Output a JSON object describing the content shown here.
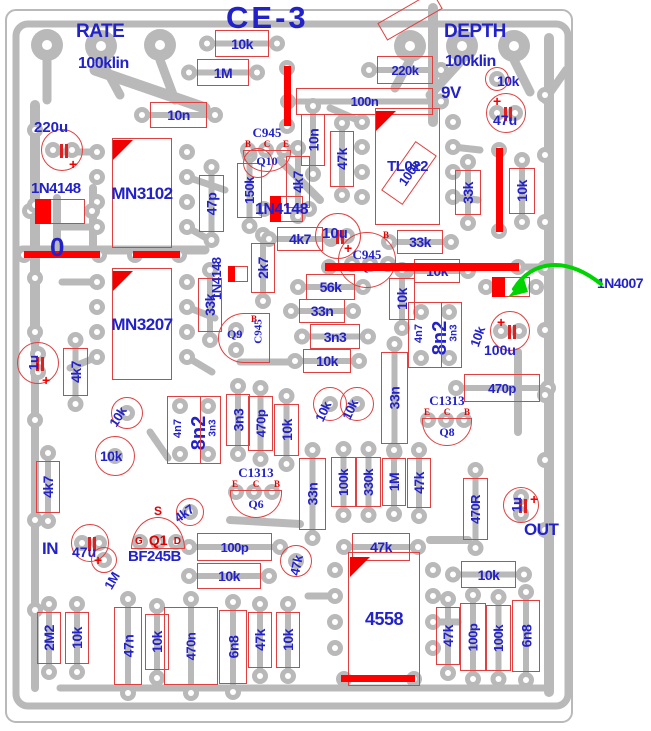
{
  "title": "CE-3",
  "colors": {
    "trace": "#b9b9b9",
    "outline": "#e04040",
    "label_blue": "#2222c8",
    "jumper_red": "#ff0000",
    "arrow_green": "#00d400",
    "background": "#ffffff"
  },
  "annotations": [
    {
      "t": "RATE",
      "x": 76,
      "y": 22,
      "s": 19
    },
    {
      "t": "100klin",
      "x": 78,
      "y": 56,
      "s": 16
    },
    {
      "t": "DEPTH",
      "x": 444,
      "y": 22,
      "s": 19
    },
    {
      "t": "100klin",
      "x": 445,
      "y": 54,
      "s": 16
    },
    {
      "t": "9V",
      "x": 441,
      "y": 84,
      "s": 17
    },
    {
      "t": "IN",
      "x": 42,
      "y": 540,
      "s": 17
    },
    {
      "t": "OUT",
      "x": 524,
      "y": 521,
      "s": 17
    },
    {
      "t": "1N4007",
      "x": 597,
      "y": 276,
      "s": 14
    },
    {
      "t": "0",
      "x": 50,
      "y": 234,
      "s": 26
    },
    {
      "t": "10k",
      "x": 497,
      "y": 74,
      "s": 14
    },
    {
      "t": "1N4148",
      "x": 31,
      "y": 181,
      "s": 15
    },
    {
      "t": "1N4148",
      "x": 255,
      "y": 202,
      "s": 16
    },
    {
      "t": "1N4148",
      "x": 210,
      "y": 300,
      "s": 13,
      "r": -90
    },
    {
      "t": "4k7",
      "x": 172,
      "y": 514,
      "s": 13,
      "r": -35
    },
    {
      "t": "1M",
      "x": 102,
      "y": 585,
      "s": 13,
      "r": -60
    },
    {
      "t": "47k",
      "x": 288,
      "y": 574,
      "s": 13,
      "r": -78
    },
    {
      "t": "10k",
      "x": 107,
      "y": 422,
      "s": 13,
      "r": -58
    },
    {
      "t": "10k",
      "x": 313,
      "y": 418,
      "s": 13,
      "r": -65
    },
    {
      "t": "10k",
      "x": 340,
      "y": 416,
      "s": 13,
      "r": -65
    },
    {
      "t": "10k",
      "x": 468,
      "y": 344,
      "s": 13,
      "r": -70
    },
    {
      "t": "10k",
      "x": 100,
      "y": 449,
      "s": 14
    },
    {
      "t": "BF245B",
      "x": 128,
      "y": 549,
      "s": 15
    }
  ],
  "components": [
    {
      "l": "10k",
      "x": 215,
      "y": 30,
      "w": 54,
      "h": 27
    },
    {
      "l": "1M",
      "x": 197,
      "y": 59,
      "w": 52,
      "h": 27
    },
    {
      "l": "220k",
      "x": 377,
      "y": 56,
      "w": 56,
      "h": 28
    },
    {
      "l": "100n",
      "x": 296,
      "y": 88,
      "w": 137,
      "h": 27
    },
    {
      "l": "10n",
      "x": 150,
      "y": 102,
      "w": 57,
      "h": 26
    },
    {
      "l": "10n",
      "x": 301,
      "y": 114,
      "w": 24,
      "h": 52,
      "rot": 90
    },
    {
      "l": "47k",
      "x": 330,
      "y": 131,
      "w": 24,
      "h": 56,
      "rot": 90
    },
    {
      "l": "4k7",
      "x": 286,
      "y": 156,
      "w": 24,
      "h": 52,
      "rot": 90
    },
    {
      "l": "150k",
      "x": 237,
      "y": 163,
      "w": 25,
      "h": 55,
      "rot": 90
    },
    {
      "l": "47p",
      "x": 199,
      "y": 175,
      "w": 25,
      "h": 57,
      "rot": 90
    },
    {
      "l": "33k",
      "x": 455,
      "y": 170,
      "w": 26,
      "h": 45,
      "rot": 90
    },
    {
      "l": "10k",
      "x": 509,
      "y": 168,
      "w": 26,
      "h": 46,
      "rot": 90
    },
    {
      "l": "",
      "x": 378,
      "y": 6,
      "w": 64,
      "h": 20,
      "rot": -30,
      "diag": 1
    },
    {
      "l": "100k",
      "x": 379,
      "y": 160,
      "w": 60,
      "h": 26,
      "rot": -55,
      "diag": 1
    },
    {
      "l": "33k",
      "x": 198,
      "y": 278,
      "w": 24,
      "h": 54,
      "rot": 90
    },
    {
      "l": "2k7",
      "x": 251,
      "y": 243,
      "w": 24,
      "h": 50,
      "rot": 90
    },
    {
      "l": "4k7",
      "x": 277,
      "y": 227,
      "w": 46,
      "h": 24
    },
    {
      "l": "33k",
      "x": 397,
      "y": 230,
      "w": 46,
      "h": 24
    },
    {
      "l": "56k",
      "x": 306,
      "y": 274,
      "w": 49,
      "h": 26
    },
    {
      "l": "10k",
      "x": 414,
      "y": 259,
      "w": 46,
      "h": 24
    },
    {
      "l": "33n",
      "x": 299,
      "y": 299,
      "w": 46,
      "h": 24
    },
    {
      "l": "3n3",
      "x": 310,
      "y": 324,
      "w": 50,
      "h": 25
    },
    {
      "l": "10k",
      "x": 303,
      "y": 349,
      "w": 48,
      "h": 24
    },
    {
      "l": "10k",
      "x": 389,
      "y": 278,
      "w": 26,
      "h": 42,
      "rot": 90
    },
    {
      "l": "33n",
      "x": 381,
      "y": 352,
      "w": 27,
      "h": 92,
      "rot": 90
    },
    {
      "l": "3n3",
      "x": 226,
      "y": 394,
      "w": 24,
      "h": 52,
      "rot": 90
    },
    {
      "l": "470p",
      "x": 248,
      "y": 396,
      "w": 25,
      "h": 55,
      "rot": 90
    },
    {
      "l": "10k",
      "x": 274,
      "y": 404,
      "w": 25,
      "h": 52,
      "rot": 90
    },
    {
      "l": "4k7",
      "x": 63,
      "y": 348,
      "w": 25,
      "h": 48,
      "rot": 90
    },
    {
      "l": "4k7",
      "x": 36,
      "y": 461,
      "w": 24,
      "h": 52,
      "rot": 90
    },
    {
      "l": "470p",
      "x": 464,
      "y": 374,
      "w": 76,
      "h": 28
    },
    {
      "l": "33n",
      "x": 299,
      "y": 458,
      "w": 27,
      "h": 72,
      "rot": 90
    },
    {
      "l": "100k",
      "x": 331,
      "y": 457,
      "w": 25,
      "h": 50,
      "rot": 90
    },
    {
      "l": "330k",
      "x": 356,
      "y": 457,
      "w": 25,
      "h": 50,
      "rot": 90
    },
    {
      "l": "1M",
      "x": 382,
      "y": 458,
      "w": 24,
      "h": 48,
      "rot": 90
    },
    {
      "l": "47k",
      "x": 407,
      "y": 458,
      "w": 24,
      "h": 50,
      "rot": 90
    },
    {
      "l": "470R",
      "x": 463,
      "y": 478,
      "w": 25,
      "h": 62,
      "rot": 90
    },
    {
      "l": "100p",
      "x": 197,
      "y": 533,
      "w": 75,
      "h": 28
    },
    {
      "l": "10k",
      "x": 197,
      "y": 563,
      "w": 64,
      "h": 26
    },
    {
      "l": "47k",
      "x": 352,
      "y": 533,
      "w": 58,
      "h": 28
    },
    {
      "l": "10k",
      "x": 461,
      "y": 561,
      "w": 55,
      "h": 27
    },
    {
      "l": "2M2",
      "x": 37,
      "y": 612,
      "w": 24,
      "h": 52,
      "rot": 90
    },
    {
      "l": "10k",
      "x": 65,
      "y": 612,
      "w": 24,
      "h": 52,
      "rot": 90
    },
    {
      "l": "47n",
      "x": 114,
      "y": 607,
      "w": 28,
      "h": 78,
      "rot": 90
    },
    {
      "l": "10k",
      "x": 145,
      "y": 614,
      "w": 24,
      "h": 56,
      "rot": 90
    },
    {
      "l": "470n",
      "x": 164,
      "y": 607,
      "w": 54,
      "h": 78,
      "rot": 90
    },
    {
      "l": "6n8",
      "x": 219,
      "y": 610,
      "w": 28,
      "h": 74,
      "rot": 90
    },
    {
      "l": "47k",
      "x": 248,
      "y": 612,
      "w": 24,
      "h": 56,
      "rot": 90
    },
    {
      "l": "10k",
      "x": 276,
      "y": 612,
      "w": 24,
      "h": 56,
      "rot": 90
    },
    {
      "l": "47k",
      "x": 436,
      "y": 607,
      "w": 24,
      "h": 58,
      "rot": 90
    },
    {
      "l": "100p",
      "x": 460,
      "y": 603,
      "w": 26,
      "h": 68,
      "rot": 90
    },
    {
      "l": "100k",
      "x": 486,
      "y": 605,
      "w": 25,
      "h": 66,
      "rot": 90
    },
    {
      "l": "6n8",
      "x": 512,
      "y": 600,
      "w": 28,
      "h": 72,
      "rot": 90
    },
    {
      "l": "MN3102",
      "x": 112,
      "y": 138,
      "w": 60,
      "h": 110,
      "ic": 1,
      "fs": 17
    },
    {
      "l": "MN3207",
      "x": 112,
      "y": 268,
      "w": 60,
      "h": 112,
      "ic": 1,
      "fs": 17
    },
    {
      "l": "TL022",
      "x": 375,
      "y": 108,
      "w": 65,
      "h": 117,
      "ic": 1,
      "fs": 15
    },
    {
      "l": "4558",
      "x": 348,
      "y": 552,
      "w": 72,
      "h": 134,
      "ic": 1,
      "fs": 18
    }
  ],
  "capgroups": [
    {
      "labels": [
        "4n7",
        "8n2",
        "3n3"
      ],
      "x": 408,
      "y": 302,
      "w": 54,
      "h": 66
    },
    {
      "labels": [
        "4n7",
        "8n2",
        "3n3"
      ],
      "x": 167,
      "y": 396,
      "w": 54,
      "h": 68
    }
  ],
  "transistors": [
    {
      "part": "C945",
      "name": "Q10",
      "pins": [
        "B",
        "C",
        "E"
      ],
      "x": 240,
      "y": 126,
      "w": 54,
      "h": 46,
      "dome": "down"
    },
    {
      "part": "C945",
      "name": "Q7",
      "pins": [
        "B"
      ],
      "x": 338,
      "y": 232,
      "w": 58,
      "h": 56,
      "dome": "circle"
    },
    {
      "part": "C945",
      "name": "Q9",
      "pins": [
        "B"
      ],
      "x": 218,
      "y": 313,
      "w": 52,
      "h": 50,
      "dome": "left"
    },
    {
      "part": "C1313",
      "name": "Q8",
      "pins": [
        "E",
        "C",
        "B"
      ],
      "x": 419,
      "y": 394,
      "w": 56,
      "h": 52,
      "dome": "down"
    },
    {
      "part": "C1313",
      "name": "Q6",
      "pins": [
        "E",
        "C",
        "B"
      ],
      "x": 227,
      "y": 466,
      "w": 58,
      "h": 52,
      "dome": "down"
    },
    {
      "part": "BF245B",
      "name": "Q1",
      "pins": [
        "G",
        "S",
        "D"
      ],
      "x": 131,
      "y": 505,
      "w": 54,
      "h": 44,
      "dome": "up"
    }
  ],
  "electrolytics": [
    {
      "label": "220u",
      "cx": 62,
      "cy": 150,
      "r": 21,
      "lx": -28,
      "ly": -30,
      "px": 6,
      "py": 6,
      "ls": 15
    },
    {
      "label": "47u",
      "cx": 506,
      "cy": 113,
      "r": 20,
      "lx": -13,
      "ly": 0,
      "px": -14,
      "py": -20,
      "ls": 14
    },
    {
      "label": "10u",
      "cx": 338,
      "cy": 236,
      "r": 23,
      "lx": -16,
      "ly": -10,
      "px": 5,
      "py": 4,
      "ls": 15
    },
    {
      "label": "1u",
      "cx": 38,
      "cy": 363,
      "r": 21,
      "lx": -12,
      "ly": -7,
      "lr": -90,
      "px": 3,
      "py": 9,
      "ls": 13
    },
    {
      "label": "100u",
      "cx": 510,
      "cy": 331,
      "r": 20,
      "lx": -26,
      "ly": 12,
      "px": -14,
      "py": -17,
      "ls": 14
    },
    {
      "label": "1u",
      "cx": 521,
      "cy": 505,
      "r": 18,
      "lx": -12,
      "ly": -7,
      "lr": -90,
      "px": 8,
      "py": -14,
      "ls": 13
    },
    {
      "label": "47u",
      "cx": 90,
      "cy": 543,
      "r": 19,
      "lx": -18,
      "ly": 2,
      "px": 3,
      "py": 9,
      "ls": 14
    }
  ],
  "diodes": [
    {
      "x": 35,
      "y": 199,
      "w": 50,
      "h": 25,
      "fw": 16
    },
    {
      "x": 270,
      "y": 196,
      "w": 33,
      "h": 26,
      "fw": 11
    },
    {
      "x": 228,
      "y": 266,
      "w": 20,
      "h": 16,
      "fw": 7
    },
    {
      "x": 492,
      "y": 277,
      "w": 38,
      "h": 20,
      "fw": 13
    }
  ],
  "jumpers": [
    {
      "x": 284,
      "y": 66,
      "w": 7,
      "h": 60
    },
    {
      "x": 496,
      "y": 148,
      "w": 7,
      "h": 84
    },
    {
      "x": 24,
      "y": 251,
      "w": 76,
      "h": 7
    },
    {
      "x": 133,
      "y": 251,
      "w": 47,
      "h": 7
    },
    {
      "x": 325,
      "y": 263,
      "w": 194,
      "h": 8
    },
    {
      "x": 341,
      "y": 675,
      "w": 74,
      "h": 7
    }
  ],
  "triangles": [
    {
      "x": 113,
      "y": 140
    },
    {
      "x": 113,
      "y": 271
    },
    {
      "x": 376,
      "y": 111
    },
    {
      "x": 350,
      "y": 557
    }
  ],
  "rings": [
    {
      "cx": 497,
      "cy": 79,
      "r": 12
    },
    {
      "cx": 104,
      "cy": 560,
      "r": 13
    },
    {
      "cx": 115,
      "cy": 456,
      "r": 20
    },
    {
      "cx": 330,
      "cy": 404,
      "r": 17
    },
    {
      "cx": 357,
      "cy": 404,
      "r": 17
    },
    {
      "cx": 127,
      "cy": 413,
      "r": 16
    },
    {
      "cx": 258,
      "cy": 163,
      "r": 15
    },
    {
      "cx": 190,
      "cy": 512,
      "r": 14
    },
    {
      "cx": 296,
      "cy": 561,
      "r": 16
    }
  ],
  "arrow": {
    "label": "1N4007"
  }
}
